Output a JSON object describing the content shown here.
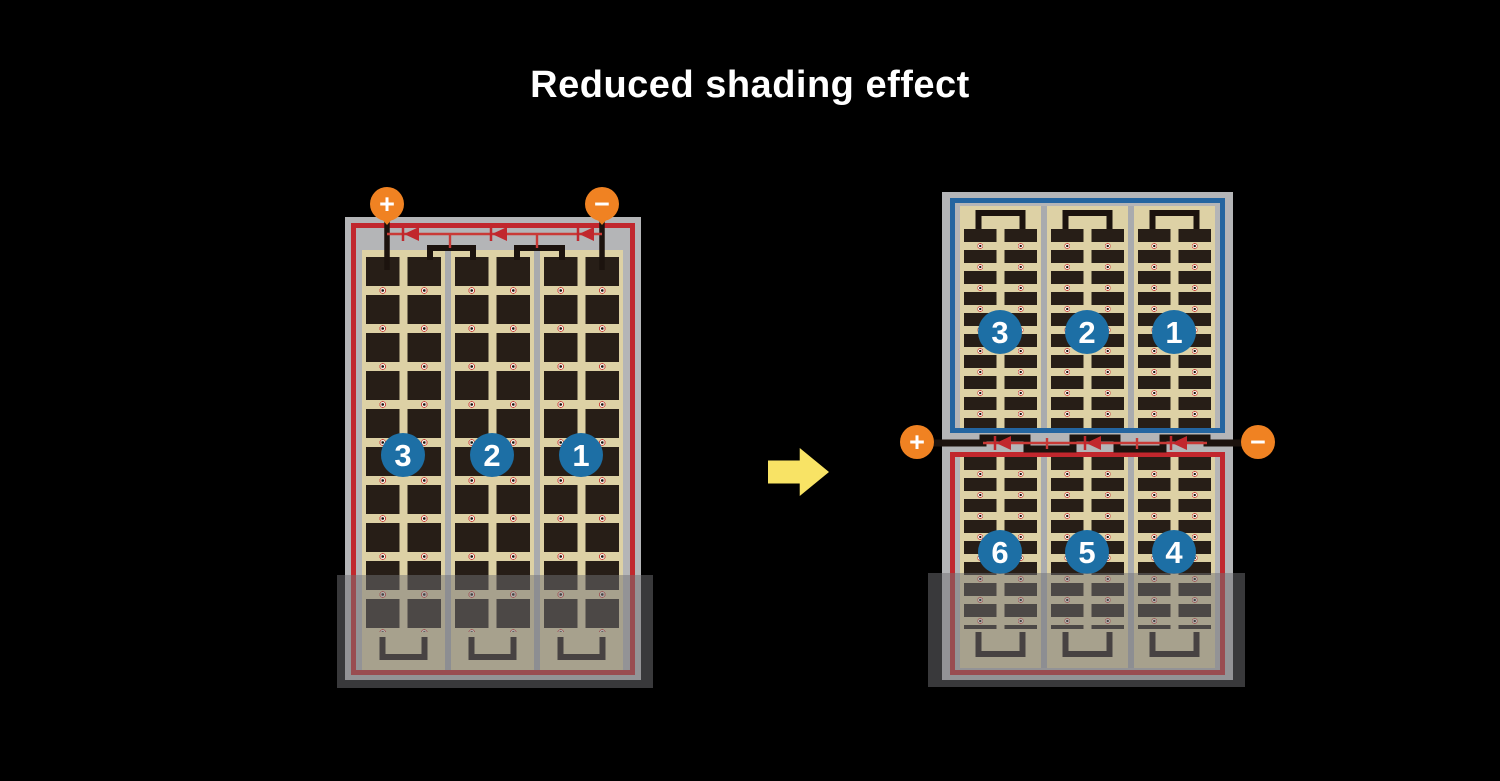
{
  "title": "Reduced shading effect",
  "left_panel": {
    "terminals": {
      "positive": "+",
      "negative": "−"
    },
    "string_labels": [
      "3",
      "2",
      "1"
    ]
  },
  "right_panel": {
    "terminals": {
      "positive": "+",
      "negative": "−"
    },
    "top_string_labels": [
      "3",
      "2",
      "1"
    ],
    "bottom_string_labels": [
      "6",
      "5",
      "4"
    ]
  },
  "colors": {
    "bg": "#000000",
    "orange": "#f08222",
    "circle_blue": "#1d6fa5",
    "red": "#c1272d",
    "blue": "#2465a0",
    "diode_red": "#c93a36",
    "tan": "#ddd1a5",
    "cell": "#271e17",
    "frame": "#b4b5b7",
    "sep": "#a9abae",
    "wire": "#1c130e",
    "yellow": "#f8e365",
    "shade": "rgba(113,114,117,0.5)"
  }
}
